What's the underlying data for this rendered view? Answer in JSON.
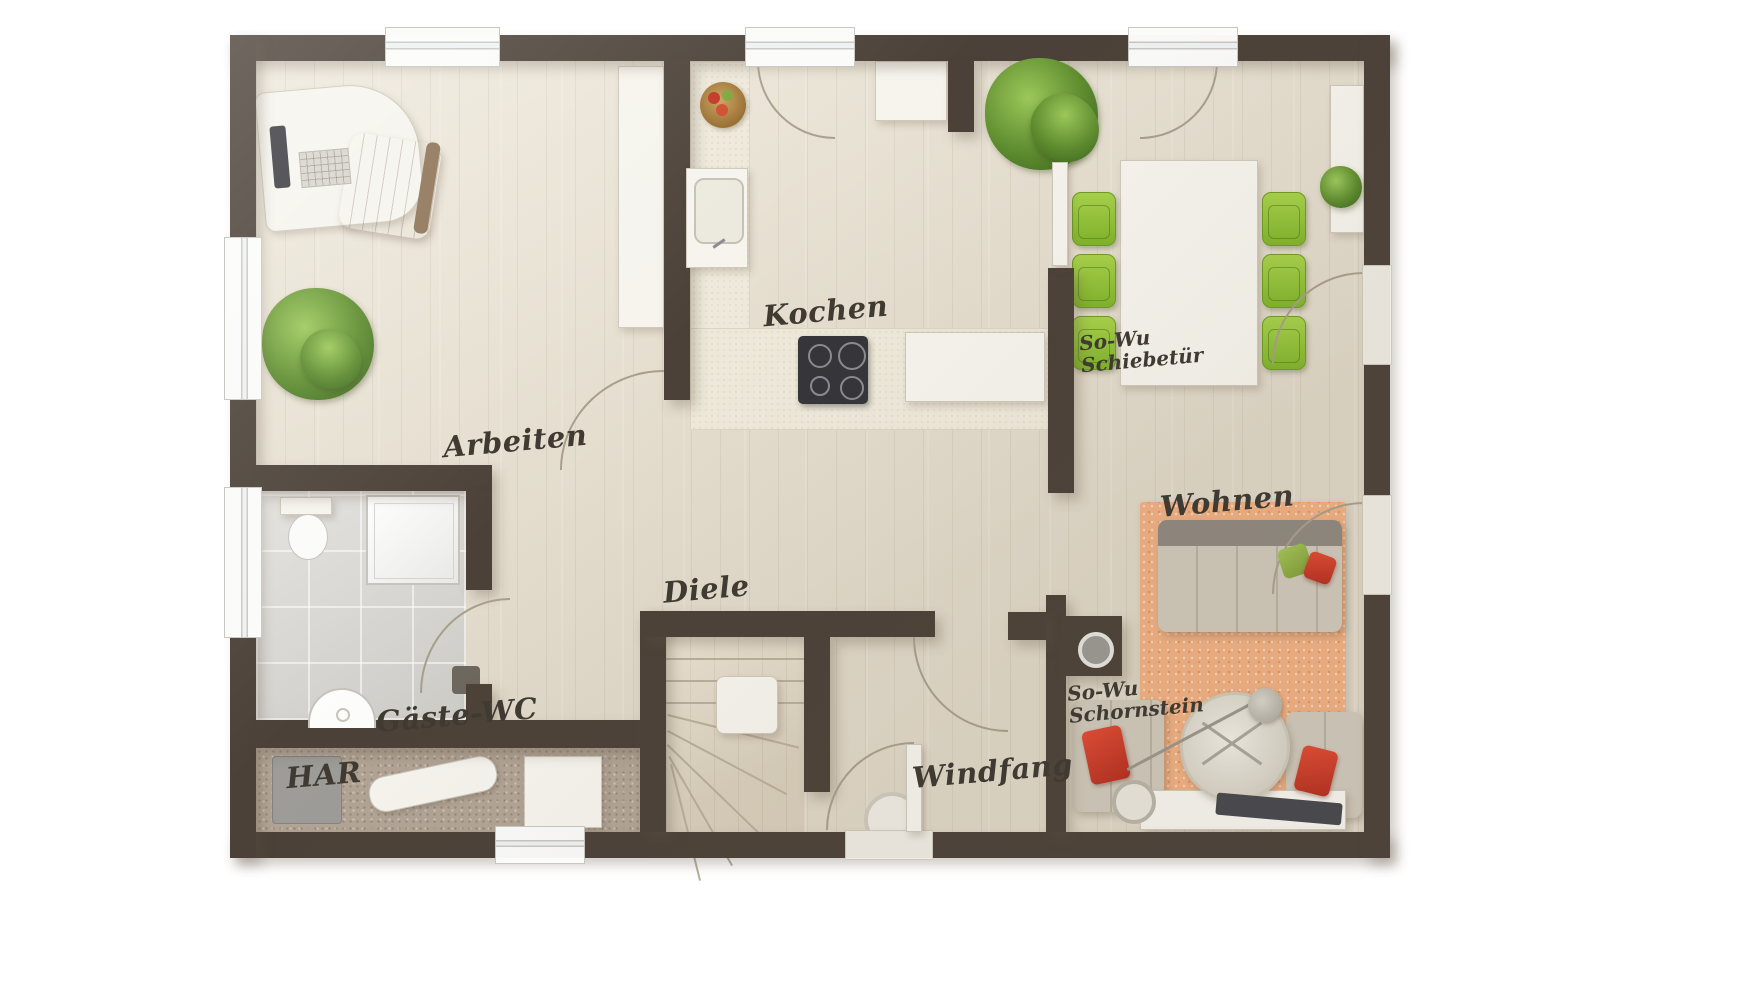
{
  "floorplan": {
    "labels": {
      "arbeiten": "Arbeiten",
      "kochen": "Kochen",
      "wohnen": "Wohnen",
      "diele": "Diele",
      "windfang": "Windfang",
      "gaeste_wc": "Gäste-WC",
      "har": "HAR",
      "schiebetuer_line1": "So-Wu",
      "schiebetuer_line2": "Schiebetür",
      "schornstein_line1": "So-Wu",
      "schornstein_line2": "Schornstein"
    },
    "colors": {
      "wall": "#4b4138",
      "wood_floor": "#e9e1d0",
      "tile_floor": "#d9d7d2",
      "har_floor": "#b2a495",
      "rug_orange": "#f0b083",
      "chair_green": "#8fc43e",
      "accent_red": "#cc3526",
      "counter_cream": "#eee9da",
      "sofa_gray": "#cfc8ba",
      "plant_green": "#5d8c2e",
      "stove_dark": "#35353a"
    },
    "furniture": [
      "desk",
      "office-chair",
      "monitor",
      "keyboard",
      "plant",
      "fruit-bowl",
      "sink",
      "stove",
      "fridge",
      "dining-table",
      "dining-chairs",
      "sideboard",
      "sofa",
      "armchair",
      "coffee-table",
      "arc-lamp",
      "tv-board",
      "rug",
      "toilet",
      "shower",
      "washbasin",
      "washing-machine",
      "ironing-board",
      "stairs",
      "chimney",
      "sliding-door",
      "entrance-door",
      "doormat"
    ]
  }
}
